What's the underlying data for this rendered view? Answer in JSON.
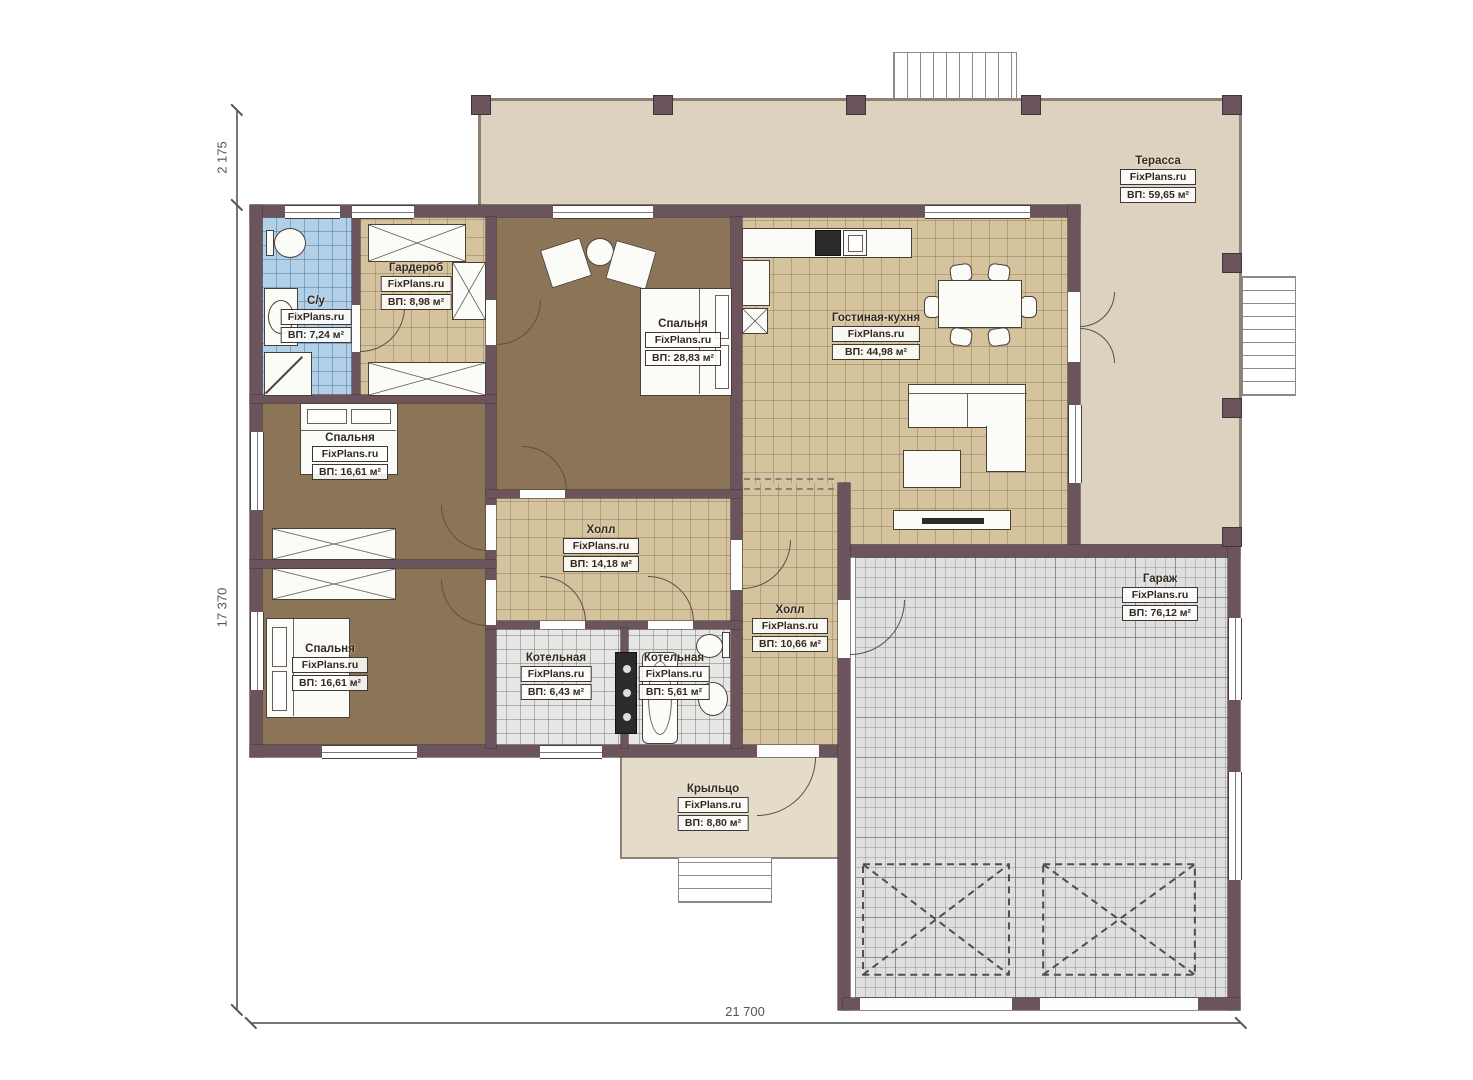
{
  "plan_title": "FixPlans.ru house floor plan",
  "watermark": "FixPlans.ru",
  "dimensions": {
    "top_left_vertical": "2 175",
    "left_vertical": "17 370",
    "bottom_horizontal": "21 700"
  },
  "rooms": [
    {
      "name": "Терасса",
      "brand": "FixPlans.ru",
      "area": "ВП: 59,65 м²"
    },
    {
      "name": "С/у",
      "brand": "FixPlans.ru",
      "area": "ВП: 7,24 м²"
    },
    {
      "name": "Гардероб",
      "brand": "FixPlans.ru",
      "area": "ВП: 8,98 м²"
    },
    {
      "name": "Спальня",
      "brand": "FixPlans.ru",
      "area": "ВП: 28,83 м²"
    },
    {
      "name": "Гостиная-кухня",
      "brand": "FixPlans.ru",
      "area": "ВП: 44,98 м²"
    },
    {
      "name": "Спальня",
      "brand": "FixPlans.ru",
      "area": "ВП: 16,61 м²"
    },
    {
      "name": "Холл",
      "brand": "FixPlans.ru",
      "area": "ВП: 14,18 м²"
    },
    {
      "name": "Спальня",
      "brand": "FixPlans.ru",
      "area": "ВП: 16,61 м²"
    },
    {
      "name": "Котельная",
      "brand": "FixPlans.ru",
      "area": "ВП: 6,43 м²"
    },
    {
      "name": "Котельная",
      "brand": "FixPlans.ru",
      "area": "ВП: 5,61 м²"
    },
    {
      "name": "Холл",
      "brand": "FixPlans.ru",
      "area": "ВП: 10,66 м²"
    },
    {
      "name": "Гараж",
      "brand": "FixPlans.ru",
      "area": "ВП: 76,12 м²"
    },
    {
      "name": "Крыльцо",
      "brand": "FixPlans.ru",
      "area": "ВП: 8,80 м²"
    }
  ],
  "colors": {
    "wall": "#6b545b",
    "terrace": "#ddd2c0",
    "tile": "#d5c39e",
    "bedroom": "#8c7557",
    "bath": "#b2d0e8",
    "utility": "#e6e6e4",
    "garage": "#dfdfdf",
    "porch": "#e5dbc9",
    "outline": "#4a4039"
  }
}
